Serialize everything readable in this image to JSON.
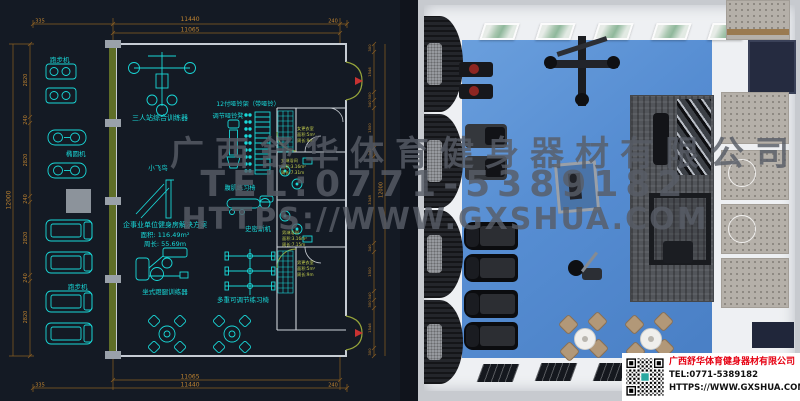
{
  "watermark": {
    "company": "广西舒华体育健身器材有限公司",
    "phone": "TEL:0771-5389182",
    "url": "HTTPS://WWW.GXSHUA.COM"
  },
  "contact_card": {
    "company": "广西舒华体育健身器材有限公司",
    "tel": "TEL:0771-5389182",
    "url": "HTTPS://WWW.GXSHUA.COM"
  },
  "cad": {
    "dims": {
      "top_total": "11440",
      "top_inner": "11065",
      "top_left": "335",
      "top_right": "240",
      "bottom_inner": "11065",
      "bottom_total": "11440",
      "bottom_left": "335",
      "bottom_right": "240",
      "left_total": "12000",
      "left_segments": [
        "2820",
        "240",
        "2820",
        "240",
        "2820",
        "240",
        "2820"
      ],
      "right_total": "12000",
      "right_segments": [
        "300",
        "1546",
        "300",
        "340",
        "1500",
        "340",
        "3348",
        "340",
        "1500",
        "340",
        "300",
        "1546",
        "300"
      ]
    },
    "labels": {
      "treadmill_top": "跑步机",
      "elliptical": "椭圆机",
      "treadmill_bottom": "跑步机",
      "triple_trainer": "三人站综合训练器",
      "dumbbell_rack": "12付哑铃架（带哑铃）",
      "dumbbell_bench": "调节哑铃凳",
      "fly_bird": "小飞鸟",
      "ab_chair": "腹肌练习椅",
      "smith_machine": "史密斯机",
      "multi_bench": "多重可调节练习椅",
      "leg_press": "坐式蹬腿训练器"
    },
    "solution": {
      "title": "企事业单位健身房解决方案",
      "area": "面积: 116.49m²",
      "perimeter": "周长: 55.69m"
    },
    "rooms": {
      "women_locker": {
        "name": "女更衣室",
        "area": "面积:5m²",
        "perimeter": "周长:9m"
      },
      "women_shower": {
        "name": "女淋浴间",
        "area": "面积:3.16m²",
        "perimeter": "周长:7.31m"
      },
      "men_shower": {
        "name": "男淋浴间",
        "area": "面积:3.16m²",
        "perimeter": "周长:7.15m"
      },
      "men_locker": {
        "name": "男更衣室",
        "area": "面积:5m²",
        "perimeter": "周长:9m"
      }
    }
  },
  "colors": {
    "cad_cyan": "#19d8d8",
    "dim_orange": "#c08430",
    "door_olive": "#97a63b",
    "floor_blue": "#5389cf",
    "accent_red": "#e60012"
  }
}
